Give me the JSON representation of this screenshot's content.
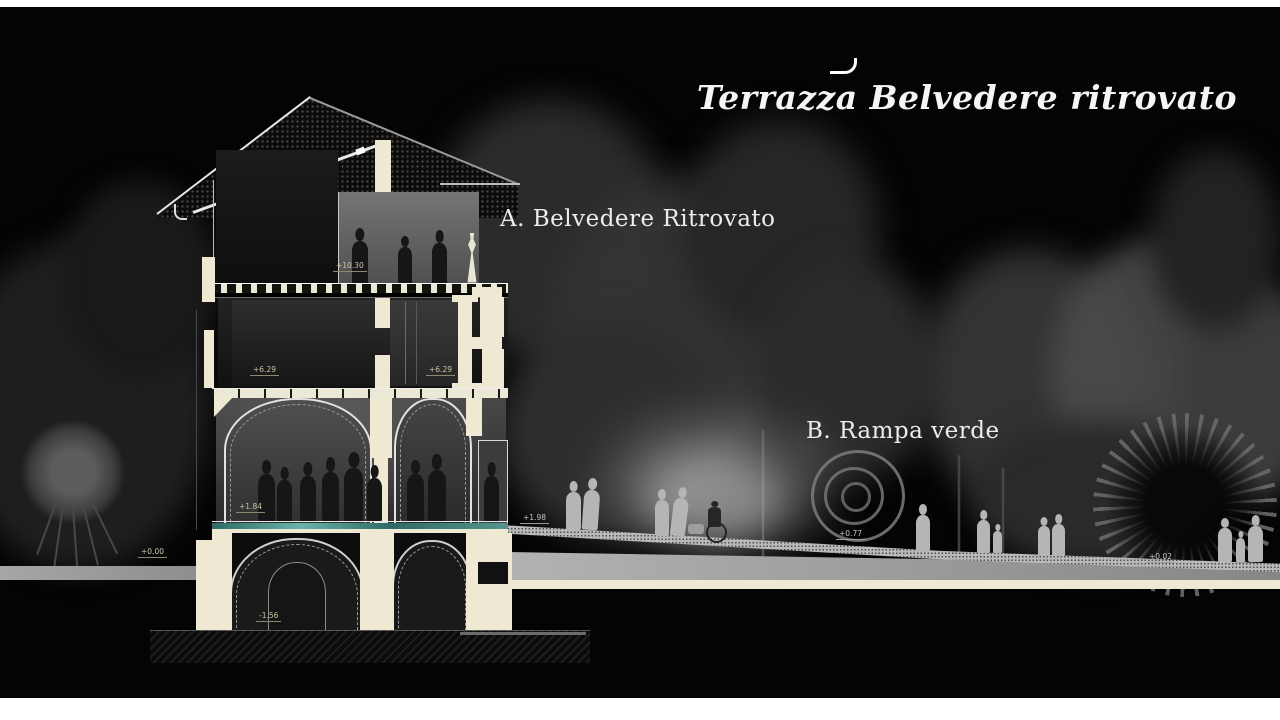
{
  "title": {
    "text": "Terrazza Belvedere ritrovato"
  },
  "annotations": {
    "label_a": "A. Belvedere Ritrovato",
    "label_b": "B. Rampa verde"
  },
  "elevation_marks": {
    "terrace": "+10.30",
    "second_floor_left": "+6.29",
    "second_floor_right": "+6.29",
    "hall_floor": "+1.84",
    "ground_left": "+0.00",
    "basement": "-1.56",
    "ramp_top": "+1.98",
    "ramp_mid": "+0.77",
    "ramp_end": "+0.02"
  },
  "colors": {
    "background": "#040404",
    "section_cut": "#efe9d3",
    "teal_floor_stripe": "#4f8d86",
    "figure_light": "#b5b5b5",
    "figure_dark": "#161616",
    "title_text": "#f5f5f5"
  }
}
